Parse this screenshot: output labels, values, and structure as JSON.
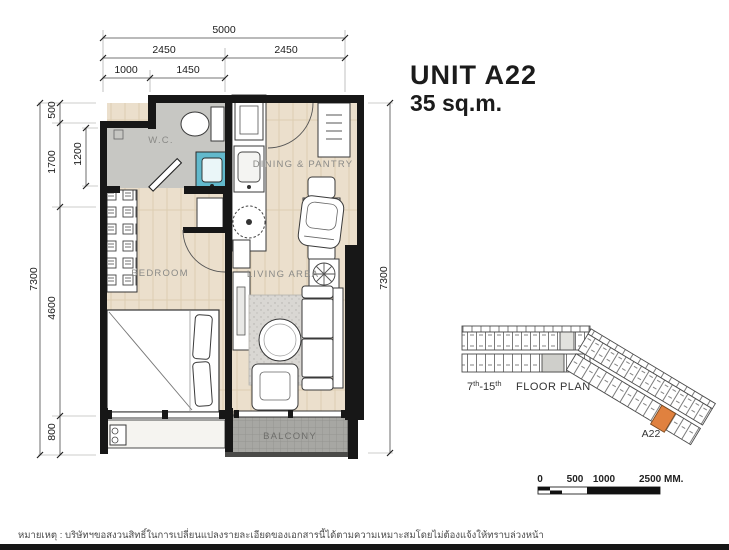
{
  "title": {
    "unit": "UNIT A22",
    "area": "35 sq.m."
  },
  "plan": {
    "rooms": {
      "wc": "W.C.",
      "dining": "DINING & PANTRY",
      "bedroom": "BEDROOM",
      "living": "LIVING AREA",
      "balcony": "BALCONY"
    },
    "dims": {
      "total_width": "5000",
      "width_left": "2450",
      "width_right": "2450",
      "sub_left": "1000",
      "sub_right": "1450",
      "total_height_left": "7300",
      "seg_500": "500",
      "seg_1700": "1700",
      "seg_1200": "1200",
      "seg_4600": "4600",
      "seg_800": "800",
      "total_height_right": "7300"
    }
  },
  "keyplan": {
    "floor_from": "7",
    "floor_from_sup": "th",
    "floor_to": "-15",
    "floor_to_sup": "th",
    "plan_label": "FLOOR PLAN",
    "unit_label": "A22"
  },
  "scalebar": {
    "t0": "0",
    "t1": "500",
    "t2": "1000",
    "t3": "2500 MM."
  },
  "colors": {
    "wall": "#171717",
    "floor": "#ebdfcc",
    "wc_floor": "#c7c7c3",
    "balcony": "#a7a7a3",
    "rug": "#d9d7d3",
    "accent": "#e0813f",
    "vanity": "#62b9cc",
    "label": "#8a8a87"
  },
  "disclaimer": "หมายเหตุ : บริษัทฯขอสงวนสิทธิ์ในการเปลี่ยนแปลงรายละเอียดของเอกสารนี้ได้ตามความเหมาะสมโดยไม่ต้องแจ้งให้ทราบล่วงหน้า"
}
